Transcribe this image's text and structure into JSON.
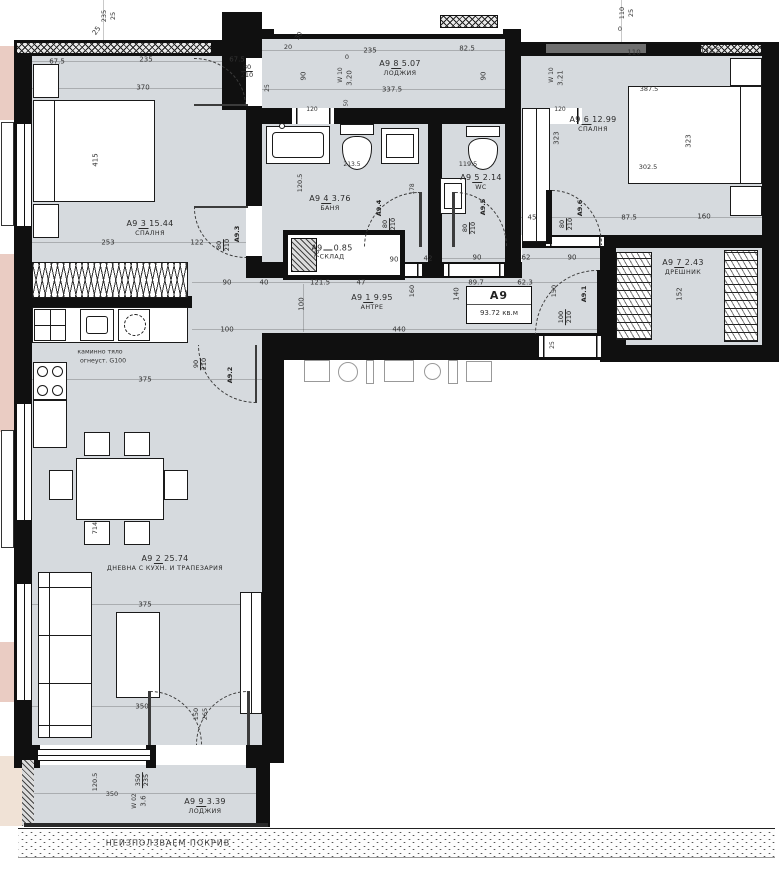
{
  "plan": {
    "unit": {
      "title": "А9",
      "area": "93.72 кв.м"
    },
    "colors": {
      "room": "#d6dade",
      "wall": "#101010",
      "accent_pink": "#eaccc3",
      "accent_beige": "#f0e2d6",
      "dim_text": "#333333",
      "door_band_gray": "#6e6e6e"
    },
    "rooms": [
      {
        "id": "bedroom-1",
        "prefix": "А9",
        "num": "3",
        "area": "15.44",
        "name": "СПАЛНЯ",
        "x": 150,
        "y": 228
      },
      {
        "id": "loggia-top",
        "prefix": "А9",
        "num": "8",
        "area": "5.07",
        "name": "ЛОДЖИЯ",
        "x": 400,
        "y": 68
      },
      {
        "id": "bedroom-2",
        "prefix": "А9",
        "num": "6",
        "area": "12.99",
        "name": "СПАЛНЯ",
        "x": 593,
        "y": 124
      },
      {
        "id": "bathroom",
        "prefix": "А9",
        "num": "4",
        "area": "3.76",
        "name": "БАНЯ",
        "x": 330,
        "y": 203
      },
      {
        "id": "wc",
        "prefix": "А9",
        "num": "5",
        "area": "2.14",
        "name": "WC",
        "x": 481,
        "y": 182
      },
      {
        "id": "dressing",
        "prefix": "А9",
        "num": "7",
        "area": "2.43",
        "name": "ДРЕШНИК",
        "x": 683,
        "y": 267
      },
      {
        "id": "hall",
        "prefix": "А9",
        "num": "1",
        "area": "9.95",
        "name": "АНТРЕ",
        "x": 372,
        "y": 302
      },
      {
        "id": "living",
        "prefix": "А9",
        "num": "2",
        "area": "25.74",
        "name": "ДНЕВНА С КУХН. И ТРАПЕЗАРИЯ",
        "x": 165,
        "y": 563
      },
      {
        "id": "loggia-bottom",
        "prefix": "А9",
        "num": "9",
        "area": "3.39",
        "name": "ЛОДЖИЯ",
        "x": 205,
        "y": 806
      },
      {
        "id": "storage",
        "prefix": "А9",
        "num": "",
        "area": "0.85",
        "name": "СКЛАД",
        "x": 332,
        "y": 252
      }
    ],
    "door_tags": [
      {
        "t": "А9.3",
        "x": 237,
        "y": 234,
        "r": -90
      },
      {
        "t": "А9.4",
        "x": 379,
        "y": 208,
        "r": -90
      },
      {
        "t": "А9.5",
        "x": 483,
        "y": 207,
        "r": -90
      },
      {
        "t": "А9.6",
        "x": 580,
        "y": 208,
        "r": -90
      },
      {
        "t": "А9.1",
        "x": 584,
        "y": 294,
        "r": -90
      },
      {
        "t": "А9.2",
        "x": 230,
        "y": 375,
        "r": -90
      }
    ],
    "fracs": [
      {
        "t": "80/210",
        "x": 247,
        "y": 72
      },
      {
        "t": "80/210",
        "x": 224,
        "y": 245,
        "r": -90
      },
      {
        "t": "80/210",
        "x": 390,
        "y": 224,
        "r": -90
      },
      {
        "t": "80/210",
        "x": 470,
        "y": 228,
        "r": -90
      },
      {
        "t": "80/210",
        "x": 567,
        "y": 224,
        "r": -90
      },
      {
        "t": "100/210",
        "x": 566,
        "y": 317,
        "r": -90
      },
      {
        "t": "90/210",
        "x": 201,
        "y": 364,
        "r": -90
      },
      {
        "t": "350/235",
        "x": 143,
        "y": 780,
        "r": -90
      }
    ],
    "dims": [
      {
        "t": "67.5",
        "x": 57,
        "y": 62
      },
      {
        "t": "235",
        "x": 146,
        "y": 60
      },
      {
        "t": "67.5",
        "x": 237,
        "y": 60
      },
      {
        "t": "370",
        "x": 143,
        "y": 88
      },
      {
        "t": "25",
        "x": 97,
        "y": 31,
        "r": -55
      },
      {
        "t": "235",
        "x": 104,
        "y": 16,
        "r": -90,
        "s": 6.5
      },
      {
        "t": "25",
        "x": 113,
        "y": 16,
        "r": -90,
        "s": 6.5
      },
      {
        "t": "415",
        "x": 96,
        "y": 160,
        "r": -90
      },
      {
        "t": "253",
        "x": 108,
        "y": 243
      },
      {
        "t": "122",
        "x": 197,
        "y": 243
      },
      {
        "t": "20",
        "x": 288,
        "y": 47,
        "s": 6.5
      },
      {
        "t": "30",
        "x": 299,
        "y": 36,
        "r": -55,
        "s": 6.5
      },
      {
        "t": "235",
        "x": 370,
        "y": 51
      },
      {
        "t": "82.5",
        "x": 467,
        "y": 49
      },
      {
        "t": "0",
        "x": 347,
        "y": 57,
        "s": 6.5
      },
      {
        "t": "90",
        "x": 304,
        "y": 76,
        "r": -90
      },
      {
        "t": "90",
        "x": 484,
        "y": 76,
        "r": -90
      },
      {
        "t": "337.5",
        "x": 392,
        "y": 90
      },
      {
        "t": "25",
        "x": 268,
        "y": 88,
        "r": -90,
        "s": 6
      },
      {
        "t": "W 10",
        "x": 341,
        "y": 75,
        "r": -90,
        "s": 6
      },
      {
        "t": "3.20",
        "x": 350,
        "y": 78,
        "r": -90
      },
      {
        "t": "W 10",
        "x": 552,
        "y": 75,
        "r": -90,
        "s": 6
      },
      {
        "t": "3.21",
        "x": 561,
        "y": 78,
        "r": -90
      },
      {
        "t": "120",
        "x": 312,
        "y": 110,
        "s": 6
      },
      {
        "t": "120",
        "x": 560,
        "y": 110,
        "s": 6
      },
      {
        "t": "50",
        "x": 347,
        "y": 103,
        "r": -90,
        "s": 5.5
      },
      {
        "t": "110",
        "x": 622,
        "y": 13,
        "r": -90,
        "s": 6.5
      },
      {
        "t": "25",
        "x": 631,
        "y": 13,
        "r": -90,
        "s": 6.5
      },
      {
        "t": "0",
        "x": 620,
        "y": 29,
        "s": 6.5
      },
      {
        "t": "110",
        "x": 634,
        "y": 53
      },
      {
        "t": "142.5",
        "x": 710,
        "y": 51
      },
      {
        "t": "387.5",
        "x": 649,
        "y": 89,
        "s": 6.5
      },
      {
        "t": "302.5",
        "x": 648,
        "y": 167,
        "s": 6.5
      },
      {
        "t": "323",
        "x": 557,
        "y": 138,
        "r": -90
      },
      {
        "t": "323",
        "x": 689,
        "y": 141,
        "r": -90
      },
      {
        "t": "87.5",
        "x": 629,
        "y": 218
      },
      {
        "t": "160",
        "x": 704,
        "y": 217
      },
      {
        "t": "45",
        "x": 532,
        "y": 218
      },
      {
        "t": "120.5",
        "x": 300,
        "y": 183,
        "r": -90,
        "s": 6.5
      },
      {
        "t": "213.5",
        "x": 352,
        "y": 165,
        "s": 6
      },
      {
        "t": "178",
        "x": 413,
        "y": 189,
        "r": -90,
        "s": 6
      },
      {
        "t": "119.5",
        "x": 468,
        "y": 164,
        "s": 6.5
      },
      {
        "t": "70",
        "x": 317,
        "y": 254,
        "r": -90,
        "s": 6.5
      },
      {
        "t": "90",
        "x": 227,
        "y": 283
      },
      {
        "t": "40",
        "x": 264,
        "y": 283
      },
      {
        "t": "121.5",
        "x": 320,
        "y": 283
      },
      {
        "t": "47",
        "x": 361,
        "y": 283
      },
      {
        "t": "90",
        "x": 394,
        "y": 260
      },
      {
        "t": "42",
        "x": 428,
        "y": 259
      },
      {
        "t": "90",
        "x": 477,
        "y": 258
      },
      {
        "t": "62",
        "x": 526,
        "y": 258
      },
      {
        "t": "90",
        "x": 572,
        "y": 258
      },
      {
        "t": "89.7",
        "x": 476,
        "y": 283
      },
      {
        "t": "62.3",
        "x": 525,
        "y": 283
      },
      {
        "t": "100",
        "x": 302,
        "y": 304,
        "r": -90
      },
      {
        "t": "160",
        "x": 412,
        "y": 291,
        "r": -90,
        "s": 6.5
      },
      {
        "t": "140",
        "x": 457,
        "y": 294,
        "r": -90
      },
      {
        "t": "150",
        "x": 554,
        "y": 291,
        "r": -90,
        "s": 6.5
      },
      {
        "t": "100",
        "x": 227,
        "y": 330
      },
      {
        "t": "440",
        "x": 399,
        "y": 330
      },
      {
        "t": "25",
        "x": 553,
        "y": 345,
        "r": -90,
        "s": 6
      },
      {
        "t": "152",
        "x": 680,
        "y": 294,
        "r": -90
      },
      {
        "t": "375",
        "x": 145,
        "y": 380
      },
      {
        "t": "375",
        "x": 145,
        "y": 605
      },
      {
        "t": "714",
        "x": 95,
        "y": 528,
        "r": -90,
        "s": 6.5
      },
      {
        "t": "350",
        "x": 142,
        "y": 707
      },
      {
        "t": "150",
        "x": 196,
        "y": 714,
        "r": -90,
        "s": 6.5
      },
      {
        "t": "265",
        "x": 205,
        "y": 714,
        "r": -90,
        "s": 6.5
      },
      {
        "t": "120.5",
        "x": 95,
        "y": 782,
        "r": -90,
        "s": 6.5
      },
      {
        "t": "350",
        "x": 112,
        "y": 794,
        "s": 6.5
      },
      {
        "t": "W 02",
        "x": 135,
        "y": 801,
        "r": -90,
        "s": 6
      },
      {
        "t": "3.6",
        "x": 144,
        "y": 801,
        "r": -90
      }
    ],
    "notes": {
      "roof": "НЕИЗПОЛЗВАЕМ ПОКРИВ",
      "kitchen_line1": "каминно тяло",
      "kitchen_line2": "огнеуст. G100"
    }
  }
}
